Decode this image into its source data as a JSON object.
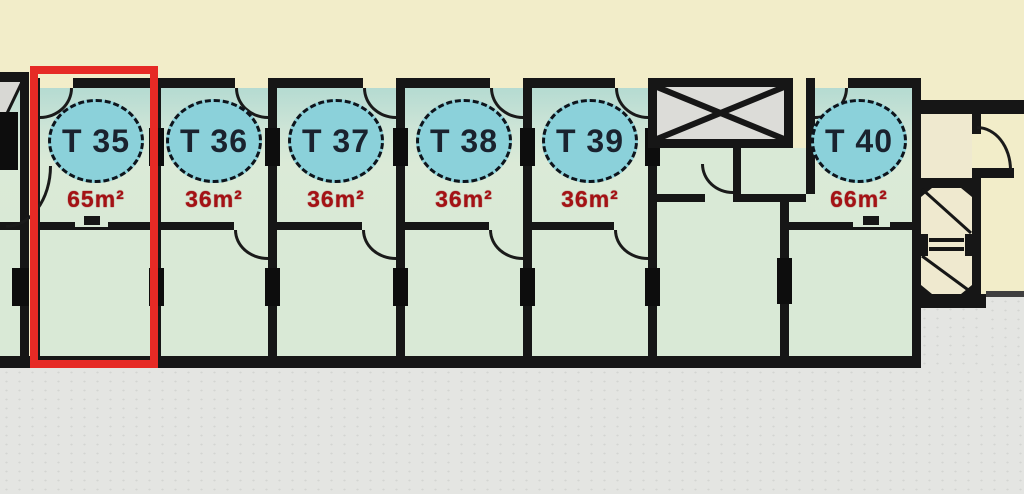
{
  "floorplan": {
    "units": [
      {
        "label": "T 35",
        "area": "65m²",
        "highlighted": true
      },
      {
        "label": "T 36",
        "area": "36m²",
        "highlighted": false
      },
      {
        "label": "T 37",
        "area": "36m²",
        "highlighted": false
      },
      {
        "label": "T 38",
        "area": "36m²",
        "highlighted": false
      },
      {
        "label": "T 39",
        "area": "36m²",
        "highlighted": false
      },
      {
        "label": "T 40",
        "area": "66m²",
        "highlighted": false
      }
    ],
    "icons": {
      "elevator": "elevator-shaft",
      "stairs": "staircase"
    },
    "colors": {
      "background": "#f2edc9",
      "ground": "#e4e5e2",
      "room_green": "#d9e9d6",
      "room_tint": "#b5dbd2",
      "wall": "#161616",
      "badge_fill": "#8bd1da",
      "badge_border": "#0d141c",
      "badge_text": "#1a222e",
      "area_text": "#a41215",
      "highlight_box": "#e62a25",
      "shaft_fill": "#dcdcd8",
      "stair_fill": "#efe9cf"
    }
  }
}
